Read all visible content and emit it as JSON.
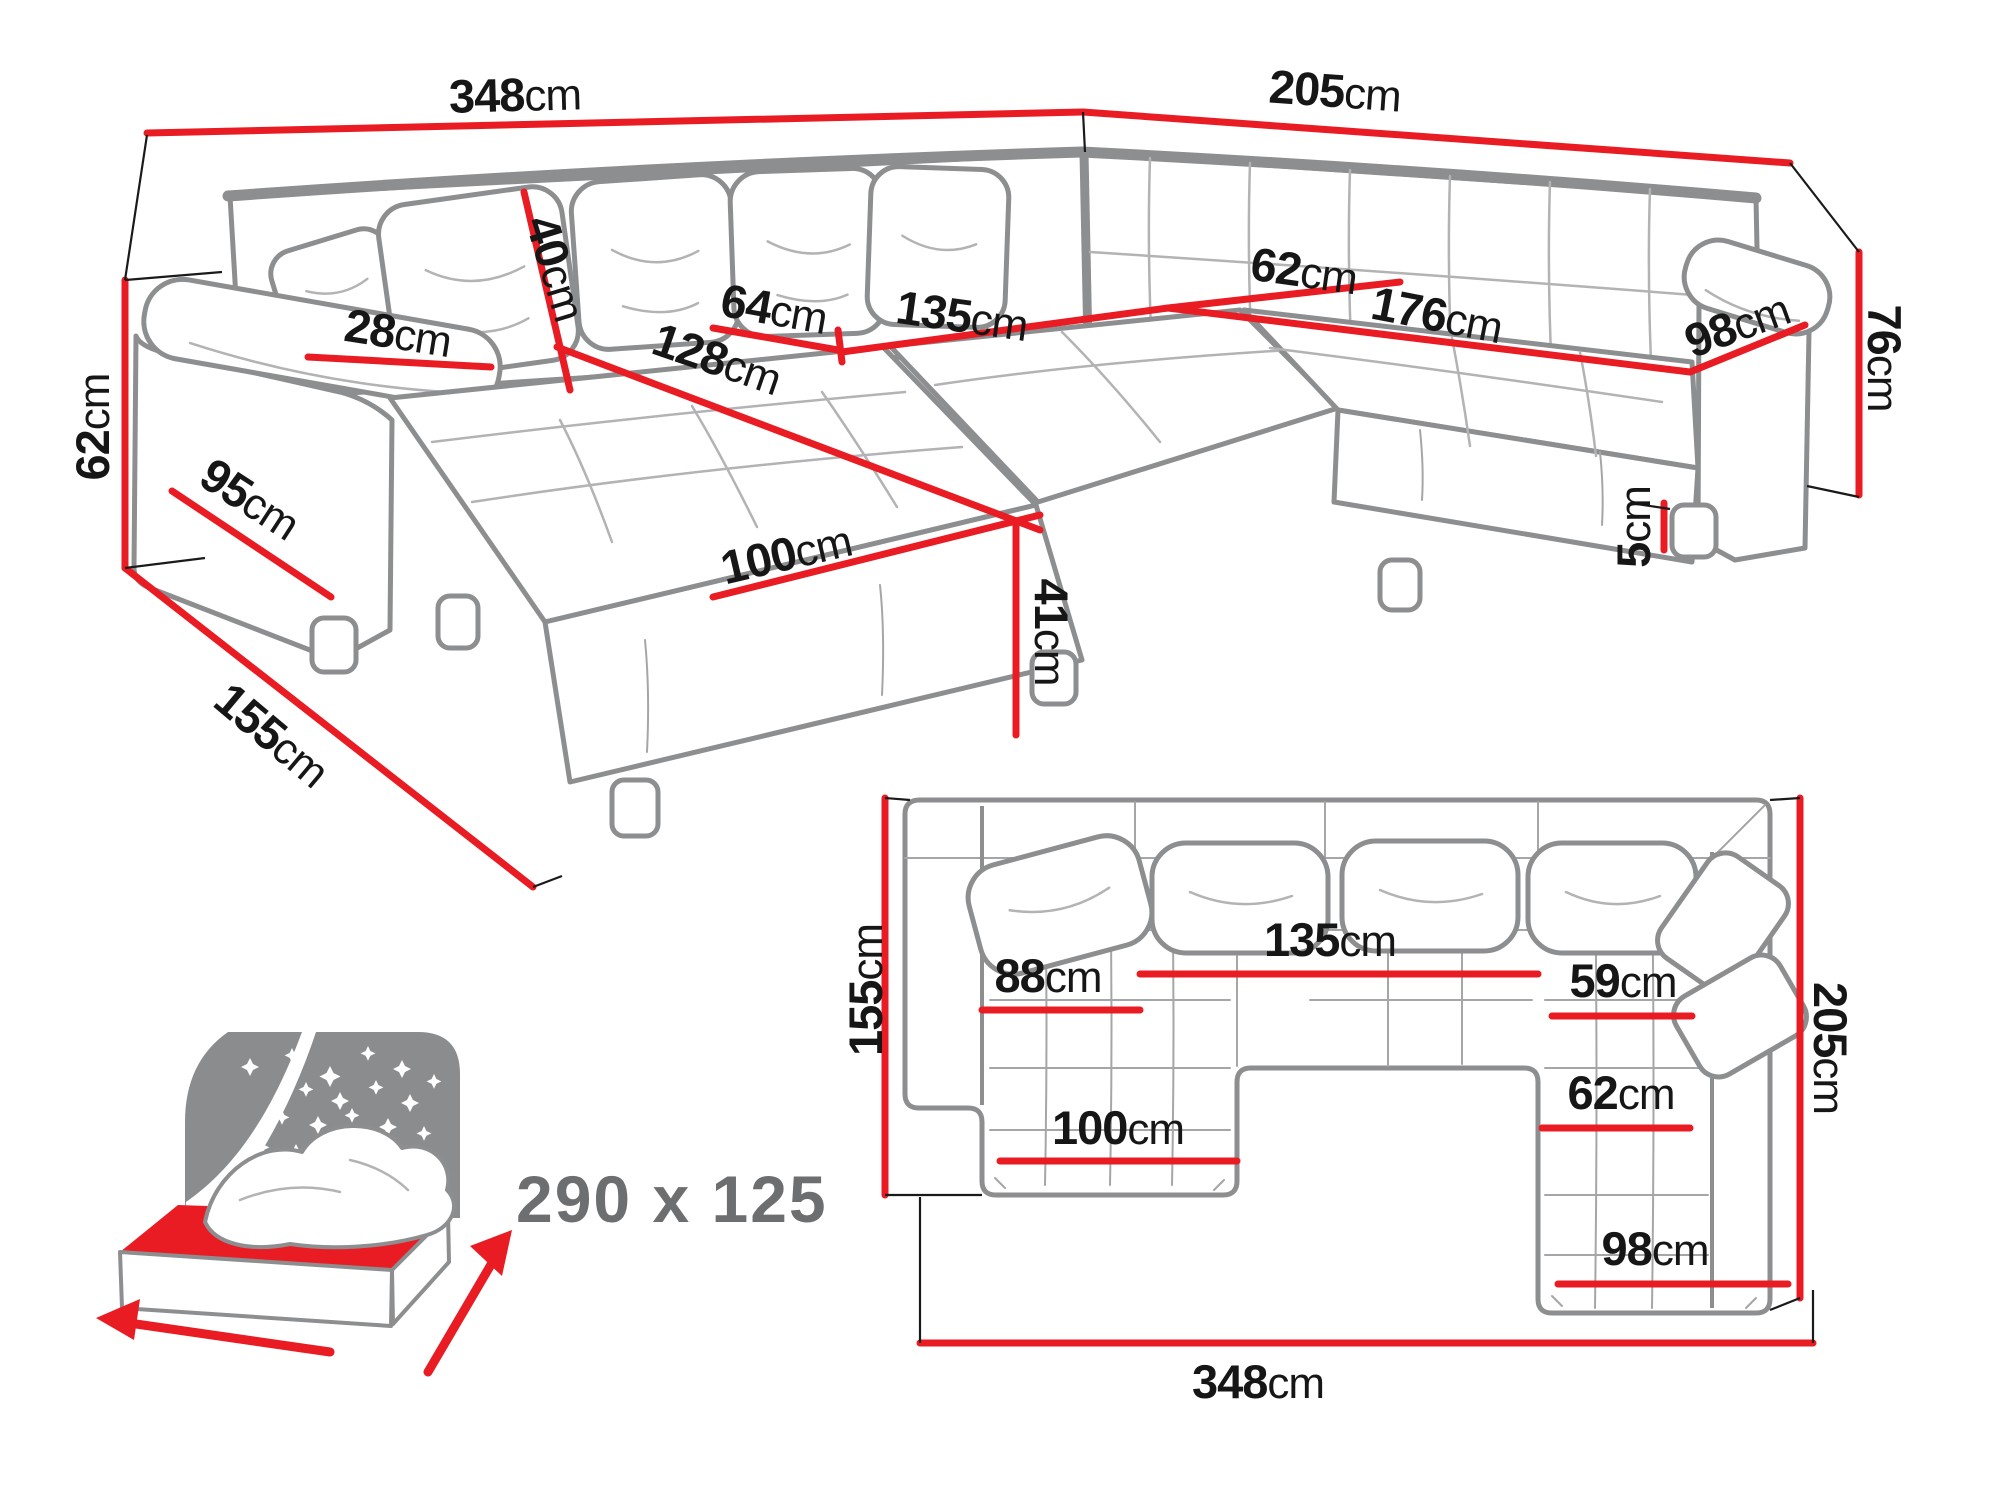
{
  "figure": {
    "type": "corner-sofa-dimension-diagram"
  },
  "colors": {
    "dimension_red": "#e81c22",
    "label_black": "#161616",
    "outline_gray": "#8d8e90",
    "sleep_gray": "#6d6e70"
  },
  "perspective": {
    "total_width": {
      "v": "348",
      "u": "cm"
    },
    "right_width": {
      "v": "205",
      "u": "cm"
    },
    "left_height": {
      "v": "62",
      "u": "cm"
    },
    "right_height": {
      "v": "76",
      "u": "cm"
    },
    "chaise_depth": {
      "v": "155",
      "u": "cm"
    },
    "arm_front": {
      "v": "95",
      "u": "cm"
    },
    "armrest_width": {
      "v": "28",
      "u": "cm"
    },
    "back_cushion_height": {
      "v": "40",
      "u": "cm"
    },
    "seat_depth": {
      "v": "64",
      "u": "cm"
    },
    "middle_seat_width": {
      "v": "135",
      "u": "cm"
    },
    "chaise_length": {
      "v": "128",
      "u": "cm"
    },
    "chaise_width": {
      "v": "100",
      "u": "cm"
    },
    "seat_height": {
      "v": "41",
      "u": "cm"
    },
    "corner_seat_depth": {
      "v": "62",
      "u": "cm"
    },
    "right_seat_length": {
      "v": "176",
      "u": "cm"
    },
    "right_seat_depth": {
      "v": "98",
      "u": "cm"
    },
    "leg_height": {
      "v": "5",
      "u": "cm"
    }
  },
  "plan": {
    "depth_left": {
      "v": "155",
      "u": "cm"
    },
    "chaise_seat_width": {
      "v": "88",
      "u": "cm"
    },
    "middle_seat_width": {
      "v": "135",
      "u": "cm"
    },
    "right_seat_width": {
      "v": "59",
      "u": "cm"
    },
    "depth_right": {
      "v": "205",
      "u": "cm"
    },
    "right_seat_depth_mid": {
      "v": "62",
      "u": "cm"
    },
    "chaise_width": {
      "v": "100",
      "u": "cm"
    },
    "right_seat_width_bottom": {
      "v": "98",
      "u": "cm"
    },
    "total_width": {
      "v": "348",
      "u": "cm"
    }
  },
  "sleeping_area": {
    "dimensions": "290 x 125"
  }
}
